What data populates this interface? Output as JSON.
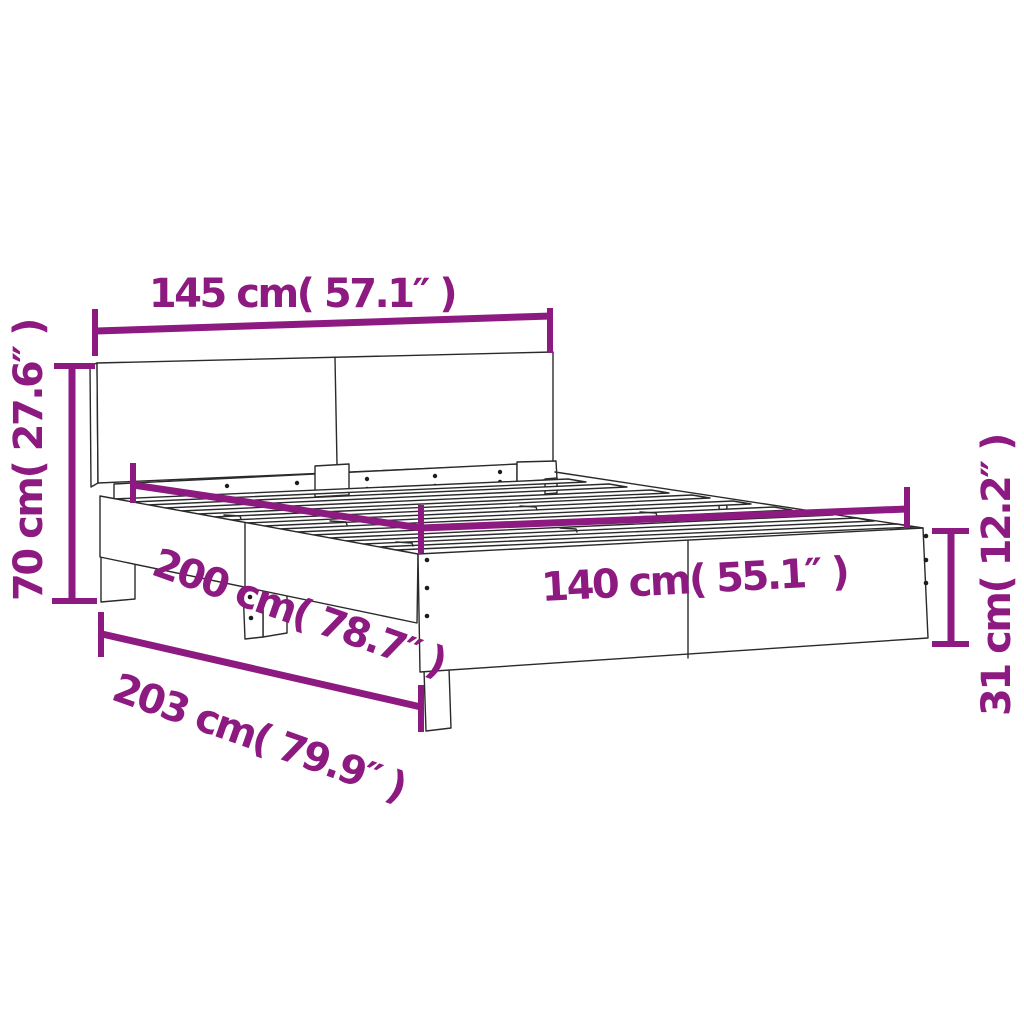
{
  "diagram": {
    "subject": "Bed frame with headboard - dimension diagram",
    "accent_color": "#8d1a80",
    "line_color": "#2a2a2a",
    "background": "#ffffff",
    "labels": {
      "headboard_width": "145 cm( 57.1″ )",
      "headboard_height": "70 cm( 27.6″ )",
      "bed_length": "200 cm( 78.7″ )",
      "bed_width": "140 cm( 55.1″ )",
      "total_length": "203 cm( 79.9″ )",
      "frame_height": "31 cm( 12.2″ )"
    }
  }
}
